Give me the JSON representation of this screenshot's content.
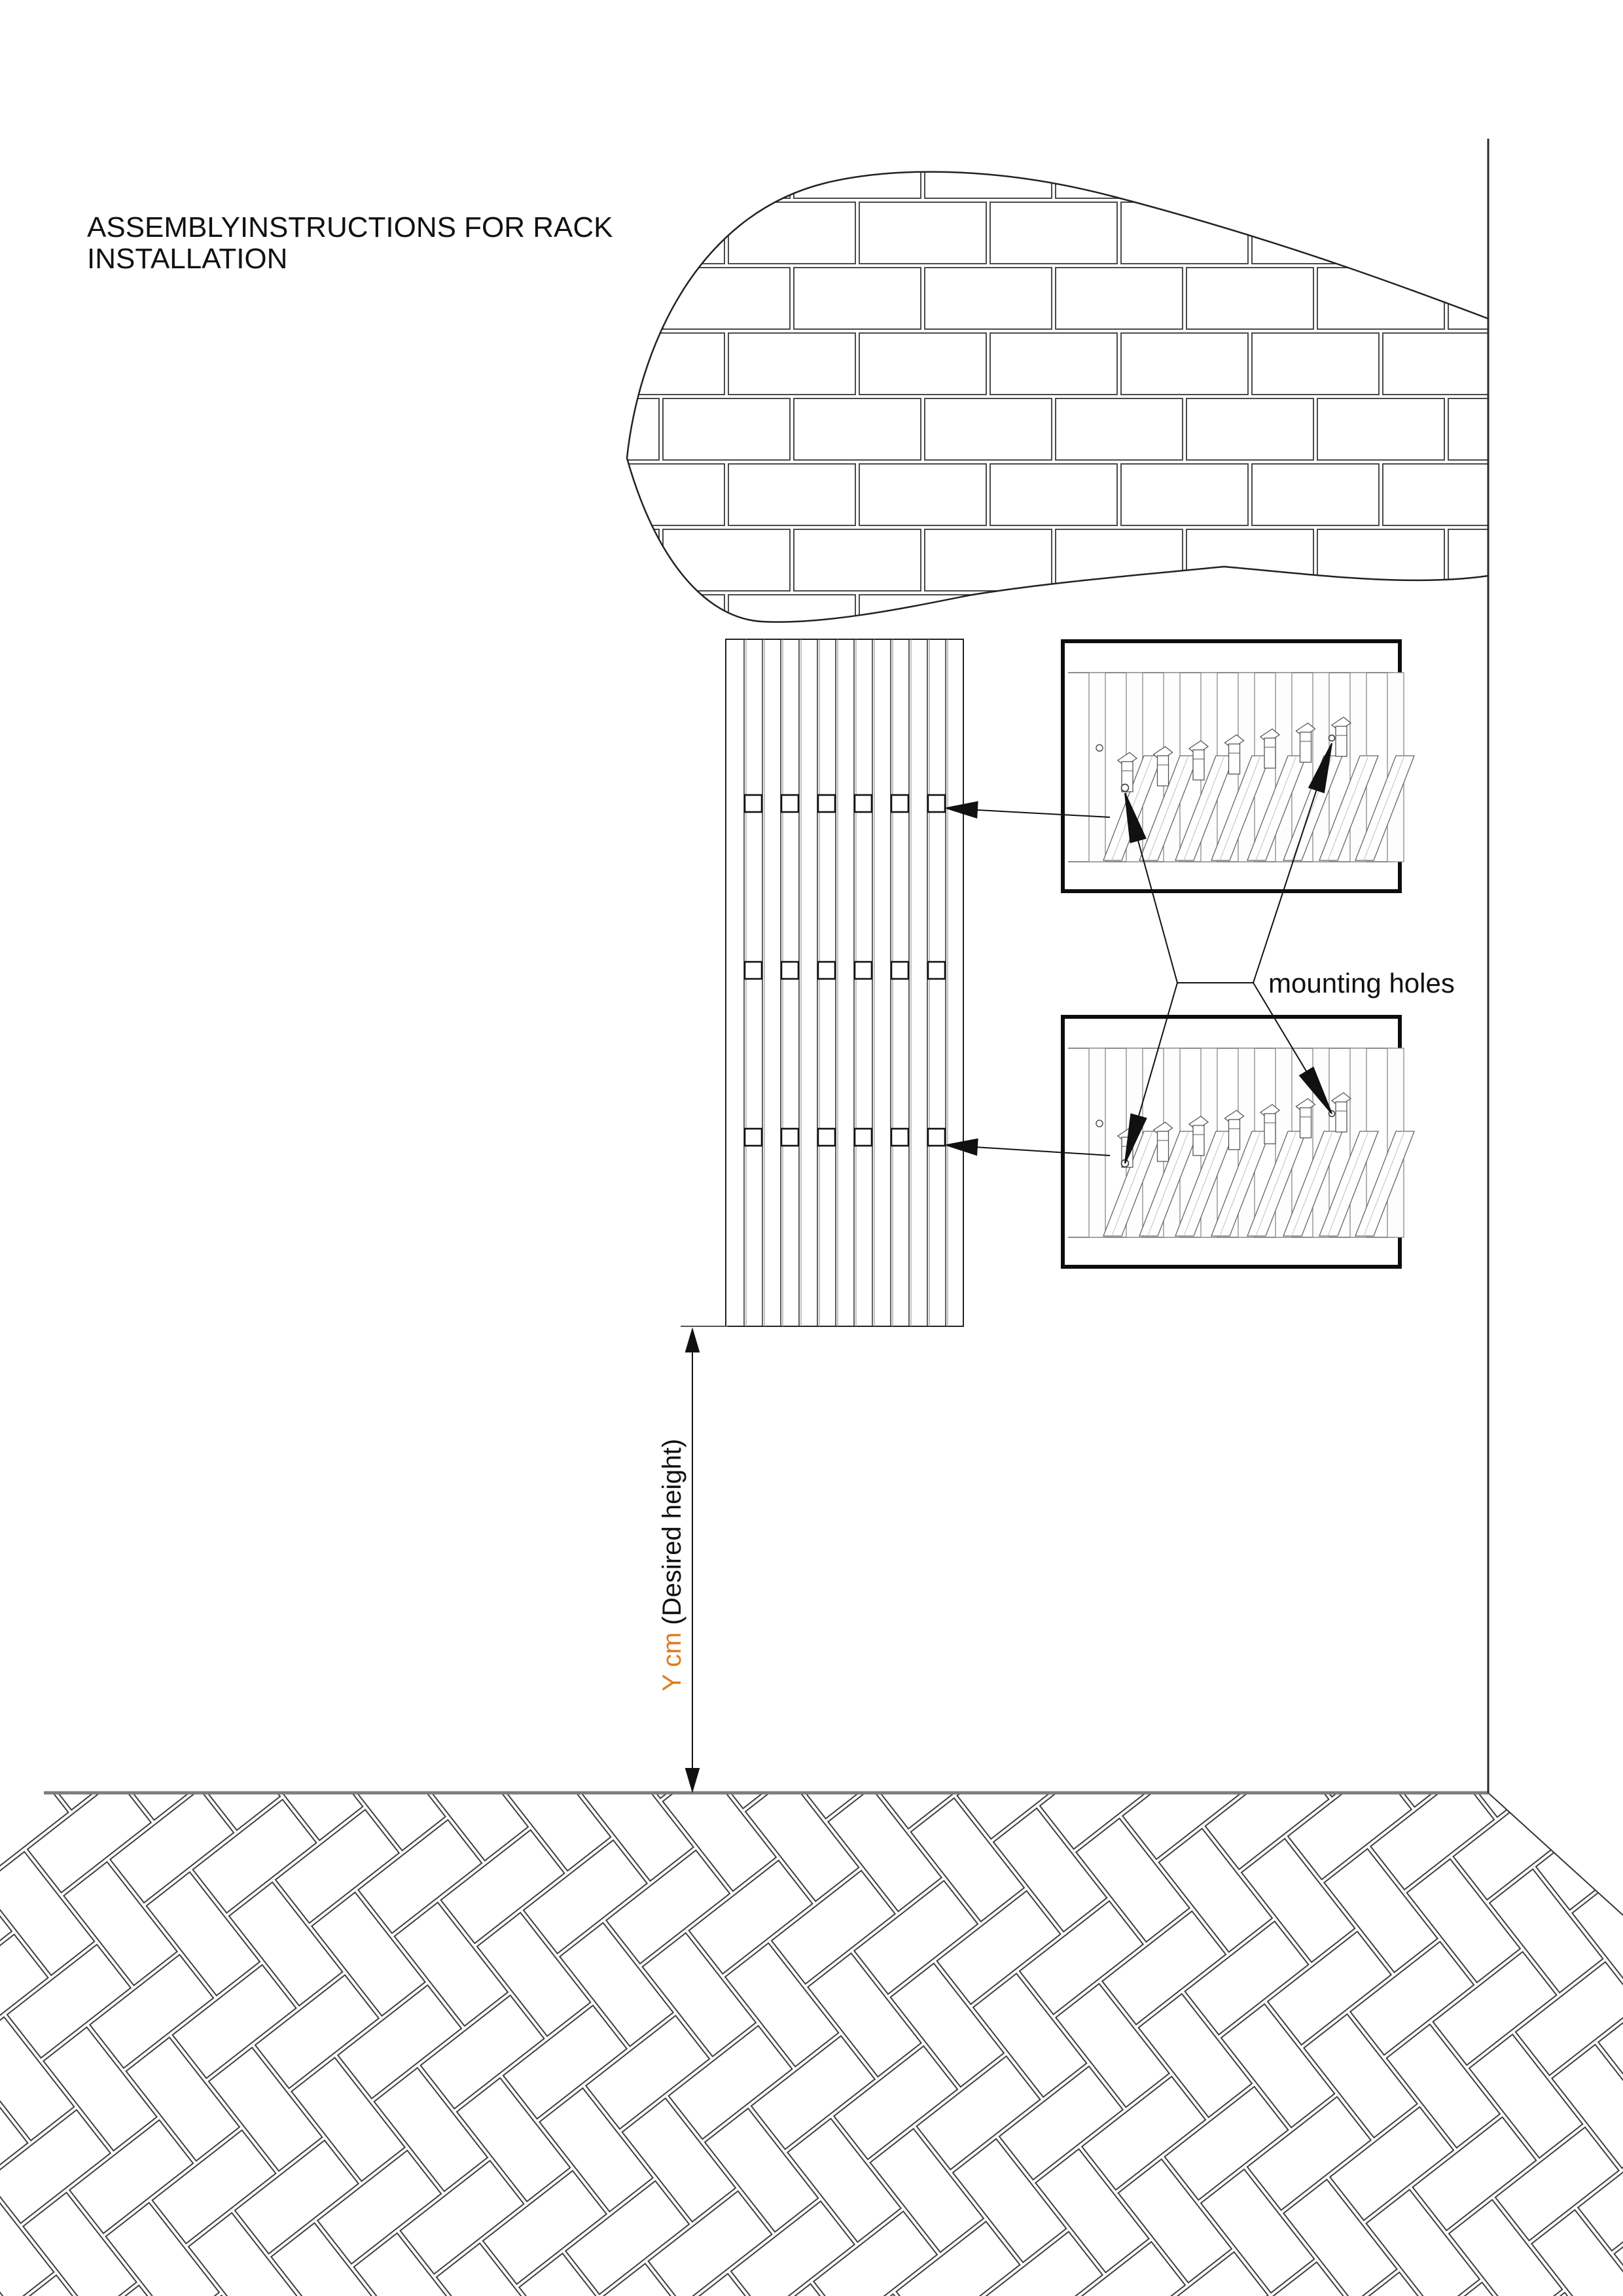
{
  "title": {
    "line1": "ASSEMBLYINSTRUCTIONS FOR RACK",
    "line2": "INSTALLATION"
  },
  "labels": {
    "mounting_holes": "mounting holes"
  },
  "dimension": {
    "value": "Y cm",
    "description": " (Desired height)"
  },
  "colors": {
    "accent": "#E07C1A",
    "ink": "#111111",
    "floor_line": "#7D7D7D",
    "wall_line": "#2B2B2B"
  },
  "figure": {
    "rack": {
      "slats": 13,
      "hole_rows": 3,
      "holes_per_row": 6
    },
    "detail_boxes": {
      "count": 2,
      "slats": 9,
      "hooks": 7,
      "planks": 8
    }
  }
}
